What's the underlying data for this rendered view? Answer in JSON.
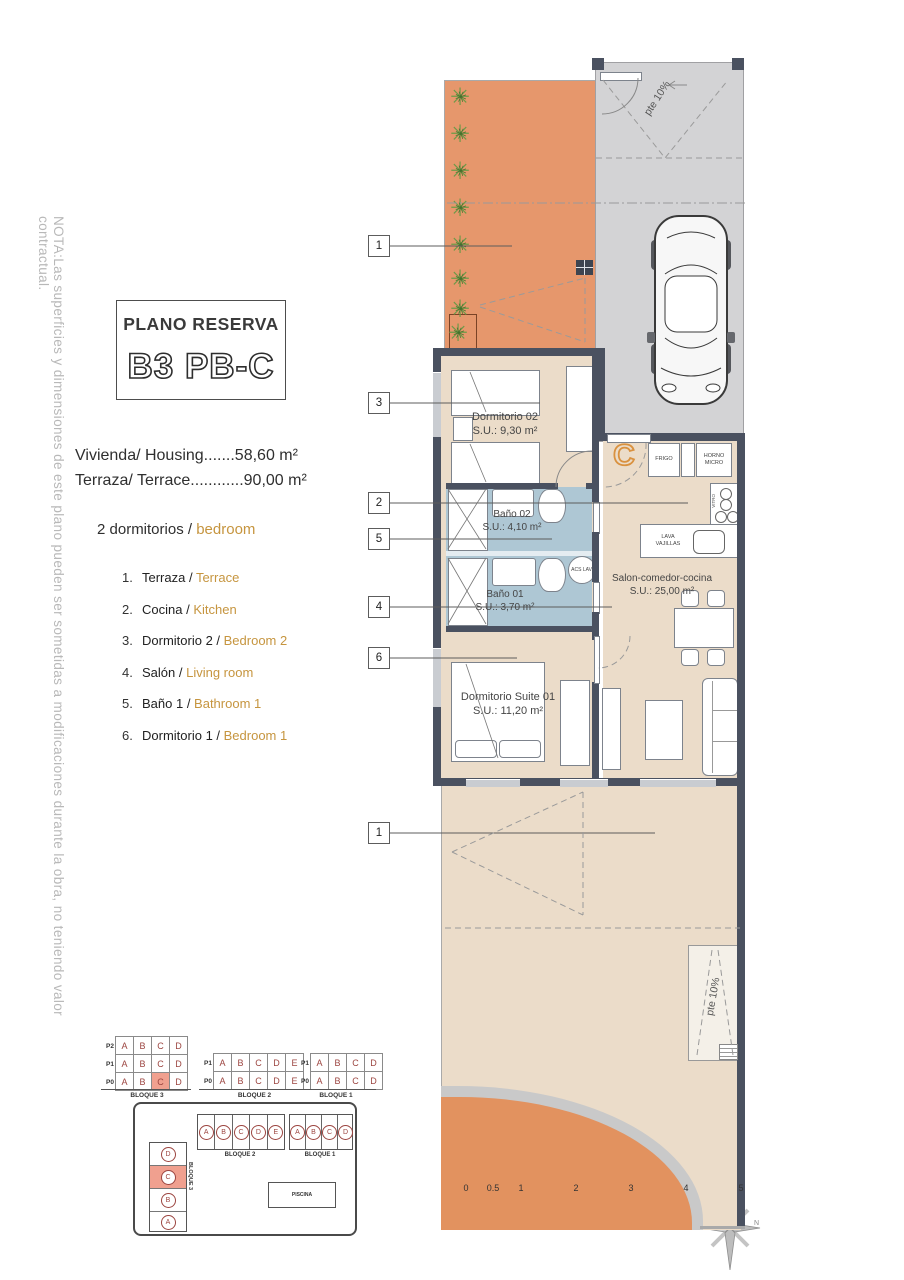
{
  "note": "NOTA:Las superficies y dimensiones de este plano pueden ser sometidas a modificaciones durante la obra, no teniendo valor contractual.",
  "title": {
    "heading": "PLANO RESERVA",
    "code": "B3 PB-C"
  },
  "surfaces": {
    "line1": "Vivienda/ Housing.......58,60 m²",
    "line2": "Terraza/ Terrace............90,00 m²"
  },
  "bedrooms": {
    "es": "2 dormitorios / ",
    "en": "bedroom"
  },
  "legend": {
    "items": [
      {
        "num": "1.",
        "es": "Terraza / ",
        "en": "Terrace"
      },
      {
        "num": "2.",
        "es": "Cocina / ",
        "en": "Kitchen"
      },
      {
        "num": "3.",
        "es": "Dormitorio 2 / ",
        "en": "Bedroom 2"
      },
      {
        "num": "4.",
        "es": "Salón / ",
        "en": "Living room"
      },
      {
        "num": "5.",
        "es": "Baño 1 / ",
        "en": "Bathroom 1"
      },
      {
        "num": "6.",
        "es": "Dormitorio 1 / ",
        "en": "Bedroom 1"
      }
    ]
  },
  "plan": {
    "unit_letter": "C",
    "ramp_label": "pte 10%",
    "rooms": {
      "dorm2": {
        "name": "Dormitorio 02",
        "area": "S.U.: 9,30 m²"
      },
      "bath2": {
        "name": "Baño 02",
        "area": "S.U.: 4,10 m²"
      },
      "bath1": {
        "name": "Baño 01",
        "area": "S.U.: 3,70 m²"
      },
      "salon": {
        "name": "Salon-comedor-cocina",
        "area": "S.U.: 25,00 m²"
      },
      "suite": {
        "name": "Dormitorio Suite 01",
        "area": "S.U.: 11,20 m²"
      }
    },
    "kitchen": {
      "fridge": "FRIGO",
      "oven": "HORNO MICRO",
      "hob": "VITRO",
      "dishwasher": "LAVA VAJILLAS",
      "water_heater": "ACS LAV."
    },
    "callouts": {
      "terrace_top": "1",
      "bedroom2": "3",
      "kitchen": "2",
      "bath1": "5",
      "salon": "4",
      "bedroom1": "6",
      "terrace_bottom": "1"
    }
  },
  "unit_tables": {
    "block3": {
      "caption": "BLOQUE 3",
      "rows": [
        {
          "label": "P2",
          "cells": [
            "A",
            "B",
            "C",
            "D"
          ]
        },
        {
          "label": "P1",
          "cells": [
            "A",
            "B",
            "C",
            "D"
          ]
        },
        {
          "label": "P0",
          "cells": [
            "A",
            "B",
            "C",
            "D"
          ]
        }
      ]
    },
    "block2": {
      "caption": "BLOQUE 2",
      "rows": [
        {
          "label": "P1",
          "cells": [
            "A",
            "B",
            "C",
            "D",
            "E"
          ]
        },
        {
          "label": "P0",
          "cells": [
            "A",
            "B",
            "C",
            "D",
            "E"
          ]
        }
      ]
    },
    "block1": {
      "caption": "BLOQUE 1",
      "rows": [
        {
          "label": "P1",
          "cells": [
            "A",
            "B",
            "C",
            "D"
          ]
        },
        {
          "label": "P0",
          "cells": [
            "A",
            "B",
            "C",
            "D"
          ]
        }
      ]
    }
  },
  "site_map": {
    "block3": {
      "caption": "BLOQUE 3",
      "units": [
        "D",
        "C",
        "B",
        "A"
      ]
    },
    "block2": {
      "caption": "BLOQUE 2",
      "units": [
        "A",
        "B",
        "C",
        "D",
        "E"
      ]
    },
    "block1": {
      "caption": "BLOQUE 1",
      "units": [
        "A",
        "B",
        "C",
        "D"
      ]
    },
    "pool": "PISCINA"
  },
  "scale_bar": {
    "ticks": [
      "0",
      "0.5",
      "1",
      "2",
      "3",
      "4",
      "5"
    ],
    "caption": "PLANTA BAJA"
  },
  "compass": {
    "north": "N"
  },
  "colors": {
    "terrace_orange": "#E6976C",
    "floor_beige": "#EBDCC9",
    "bath_blue": "#AEC7D4",
    "wall_dark": "#4A5160",
    "garage_gray": "#D3D3D5",
    "accent_orange": "#C6953F",
    "highlight_salmon": "#F0A08F",
    "maroon": "#9C4540"
  }
}
